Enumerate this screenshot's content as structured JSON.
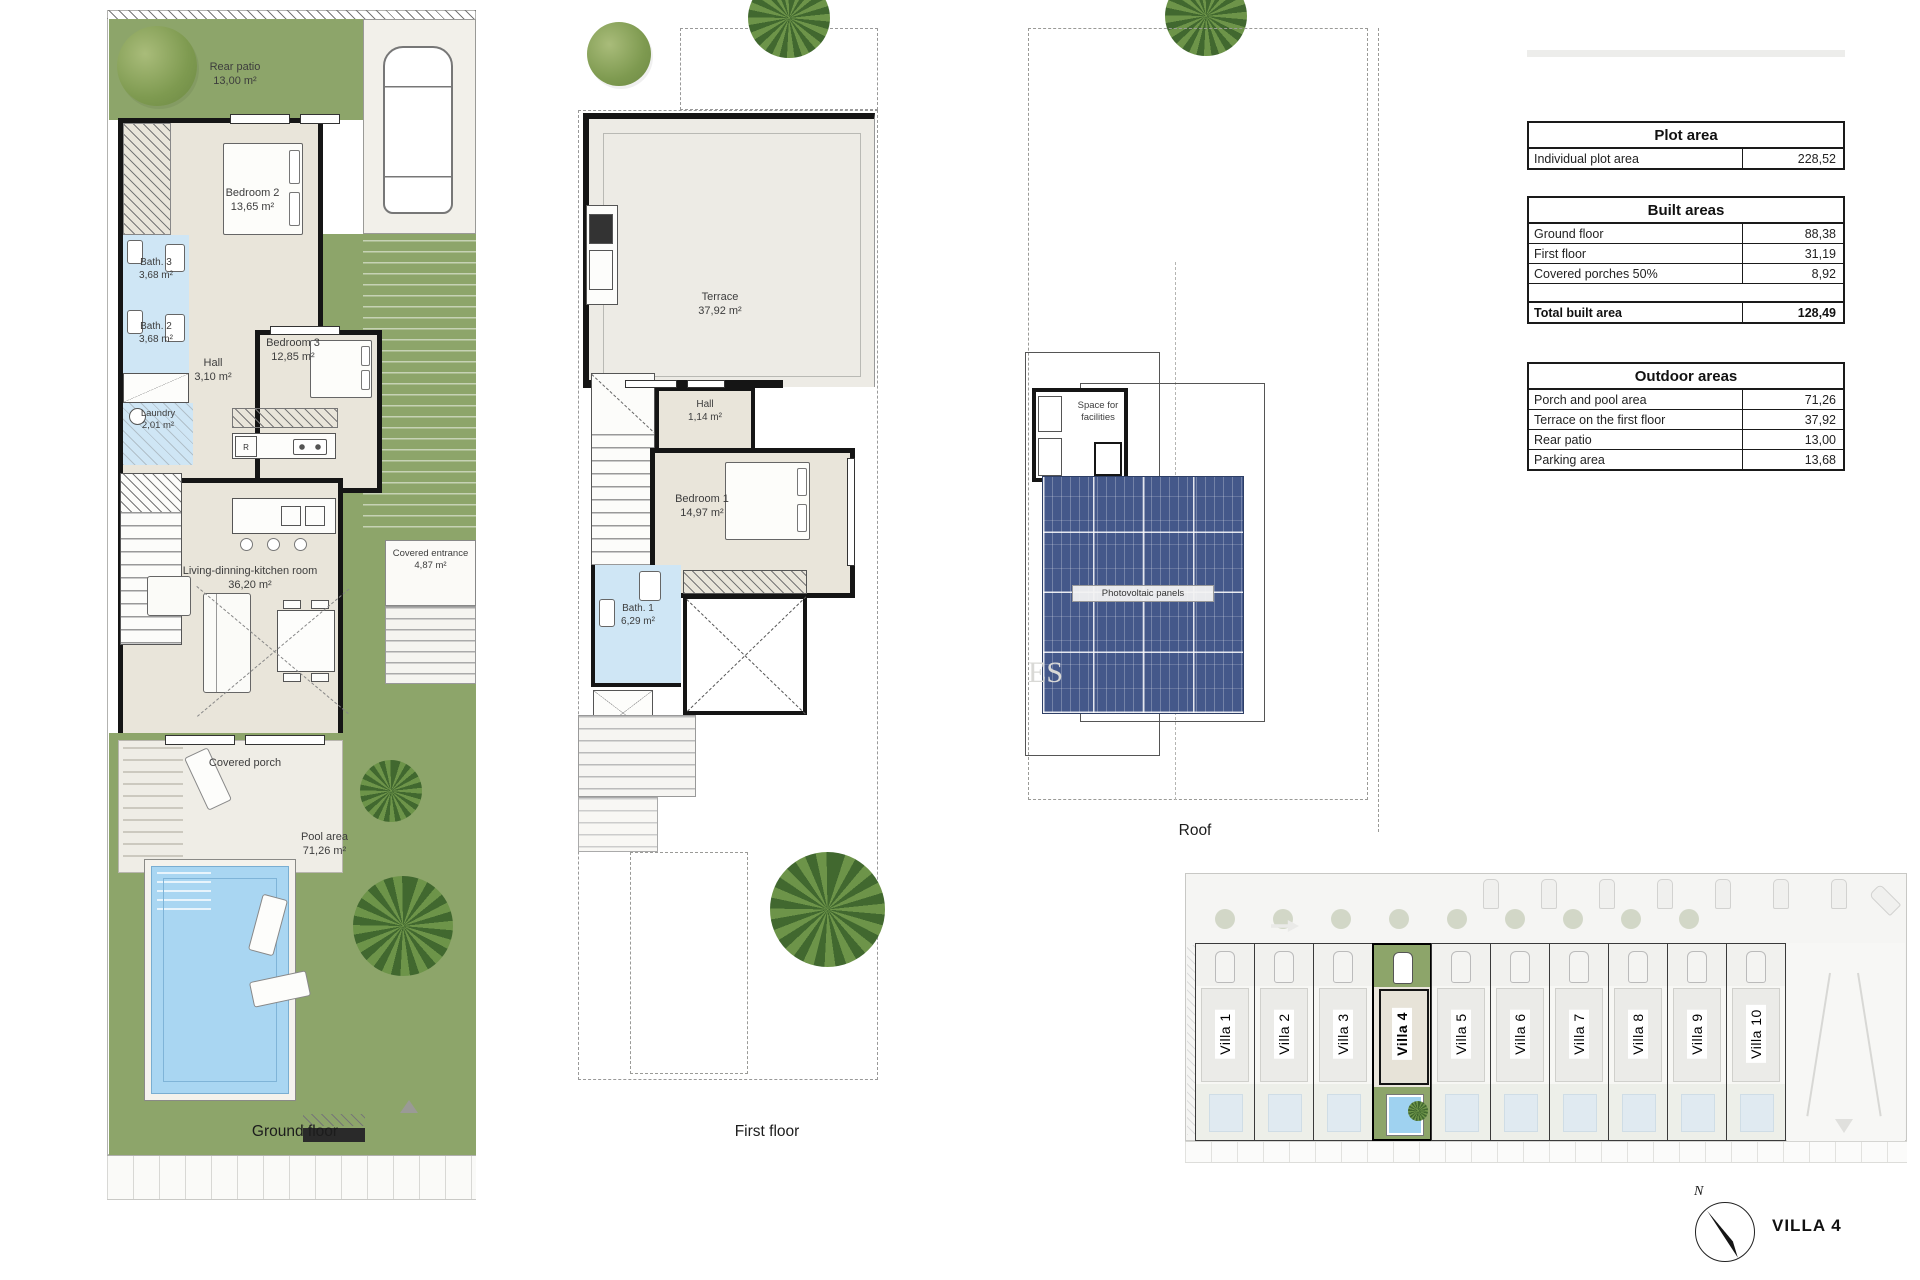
{
  "ground_floor": {
    "caption": "Ground floor",
    "kitchen_fridge": "R",
    "rooms": {
      "rear_patio": {
        "name": "Rear patio",
        "area": "13,00 m²"
      },
      "bedroom2": {
        "name": "Bedroom 2",
        "area": "13,65 m²"
      },
      "bath3": {
        "name": "Bath. 3",
        "area": "3,68 m²"
      },
      "bath2": {
        "name": "Bath. 2",
        "area": "3,68 m²"
      },
      "hall": {
        "name": "Hall",
        "area": "3,10 m²"
      },
      "bedroom3": {
        "name": "Bedroom 3",
        "area": "12,85 m²"
      },
      "laundry": {
        "name": "Laundry",
        "area": "2,01 m²"
      },
      "living": {
        "name": "Living-dinning-kitchen room",
        "area": "36,20 m²"
      },
      "covered_entrance": {
        "name": "Covered entrance",
        "area": "4,87 m²"
      },
      "covered_porch": {
        "name": "Covered porch"
      },
      "pool": {
        "name": "Pool area",
        "area": "71,26 m²"
      }
    }
  },
  "first_floor": {
    "caption": "First floor",
    "rooms": {
      "terrace": {
        "name": "Terrace",
        "area": "37,92 m²"
      },
      "hall": {
        "name": "Hall",
        "area": "1,14 m²"
      },
      "bedroom1": {
        "name": "Bedroom 1",
        "area": "14,97 m²"
      },
      "bath1": {
        "name": "Bath. 1",
        "area": "6,29 m²"
      }
    }
  },
  "roof": {
    "caption": "Roof",
    "labels": {
      "facilities": "Space for facilities",
      "pv": "Photovoltaic panels"
    }
  },
  "tables": {
    "plot": {
      "title": "Plot area",
      "rows": [
        {
          "label": "Individual plot area",
          "value": "228,52"
        }
      ]
    },
    "built": {
      "title": "Built areas",
      "rows": [
        {
          "label": "Ground floor",
          "value": "88,38"
        },
        {
          "label": "First floor",
          "value": "31,19"
        },
        {
          "label": "Covered porches 50%",
          "value": "8,92"
        }
      ],
      "total": {
        "label": "Total built area",
        "value": "128,49"
      }
    },
    "outdoor": {
      "title": "Outdoor areas",
      "rows": [
        {
          "label": "Porch and pool area",
          "value": "71,26"
        },
        {
          "label": "Terrace on the first floor",
          "value": "37,92"
        },
        {
          "label": "Rear patio",
          "value": "13,00"
        },
        {
          "label": "Parking area",
          "value": "13,68"
        }
      ]
    }
  },
  "site": {
    "villas": [
      "Villa 1",
      "Villa 2",
      "Villa 3",
      "Villa 4",
      "Villa 5",
      "Villa 6",
      "Villa 7",
      "Villa 8",
      "Villa 9",
      "Villa 10"
    ],
    "highlighted": "Villa 4"
  },
  "footer": {
    "title": "VILLA 4",
    "compass": "N"
  },
  "watermark": "ES",
  "colors": {
    "garden_green": "#8da56a",
    "bath_blue": "#cfe6f5",
    "pool_blue": "#9fd2f0",
    "pv_blue": "#44588a",
    "wall_black": "#151515"
  }
}
